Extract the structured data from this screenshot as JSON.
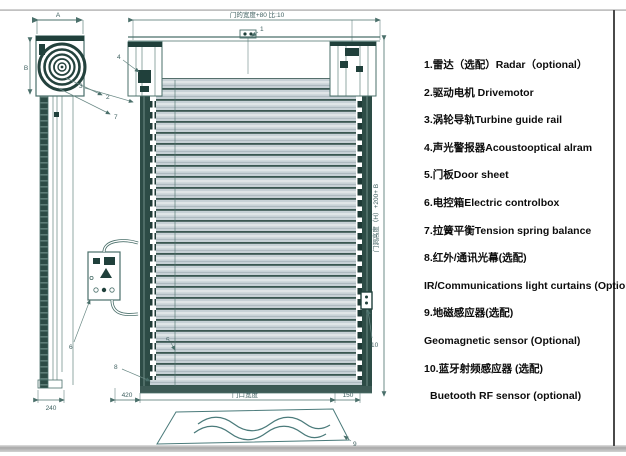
{
  "page": {
    "title": "High speed door technical diagram",
    "colors": {
      "line": "#4a6f6a",
      "dark_teal": "#20403b",
      "rail": "#2d4c46",
      "slat_light": "#c7d1d6",
      "text": "#0c0c0c"
    }
  },
  "parts_list": {
    "items": [
      {
        "line1": "1.雷达（选配）Radar（optional）"
      },
      {
        "line1": "2.驱动电机 Drivemotor"
      },
      {
        "line1": "3.涡轮导轨Turbine guide rail"
      },
      {
        "line1": "4.声光警报器Acoustooptical alram"
      },
      {
        "line1": "5.门板Door sheet"
      },
      {
        "line1": "6.电控箱Electric controlbox"
      },
      {
        "line1": "7.拉簧平衡Tension spring balance"
      },
      {
        "line1": "8.红外/通讯光幕(选配)",
        "line2": "IR/Communications light curtains (Optional)"
      },
      {
        "line1": "9.地磁感应器(选配)",
        "line2": "Geomagnetic sensor (Optional)"
      },
      {
        "line1": "10.蓝牙射频感应器 (选配)",
        "line2": "Buetooth RF sensor (optional)"
      }
    ]
  },
  "dimensions": {
    "top_width": "门的宽度+80 比:10",
    "right_height": "门洞高度（H）+200+ B",
    "bottom_left": "420",
    "bottom_center": "门口宽度",
    "bottom_right": "150",
    "side_depth": "240",
    "side_width_letter": "A",
    "side_height_letter": "B"
  },
  "leaders": {
    "l1": "1",
    "l2": "2",
    "l3": "3",
    "l4": "4",
    "l5": "5",
    "l6": "6",
    "l7": "7",
    "l8": "8",
    "l9": "9",
    "l10": "10"
  }
}
